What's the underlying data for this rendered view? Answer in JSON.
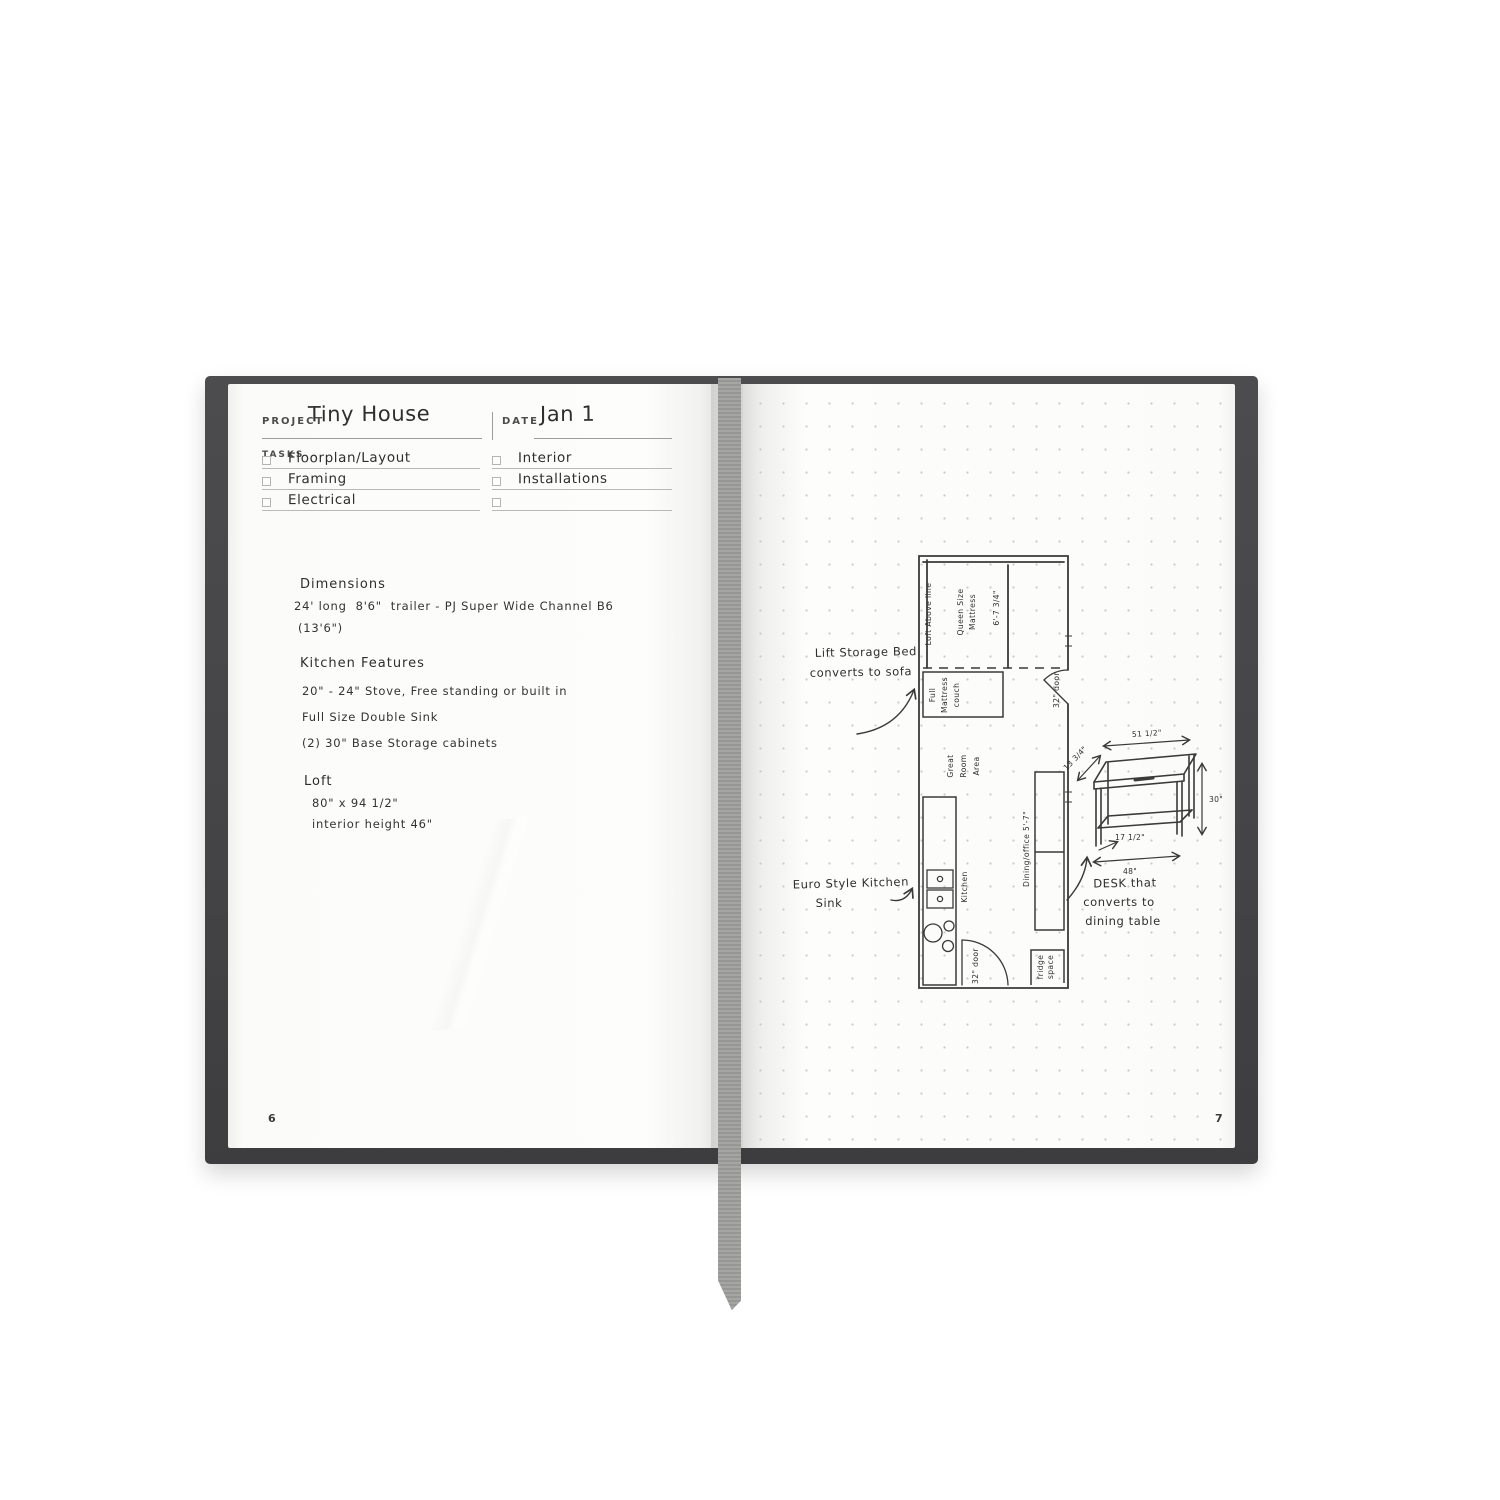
{
  "book": {
    "left_page_number": "6",
    "right_page_number": "7",
    "cover_color": "#454547",
    "ribbon_color": "#9a9a98",
    "ink_color": "#2e2e2e"
  },
  "left_page": {
    "project_label": "PROJECT",
    "project_value": "Tiny House",
    "date_label": "DATE",
    "date_value": "Jan 1",
    "tasks_label": "TASKS",
    "tasks_left": [
      "Floorplan/Layout",
      "Framing",
      "Electrical"
    ],
    "tasks_right": [
      "Interior",
      "Installations",
      ""
    ],
    "notes": {
      "dimensions_title": "Dimensions",
      "dimensions_line1": "24' long  8'6\"  trailer - PJ Super Wide Channel B6",
      "dimensions_line2": "(13'6\")",
      "kitchen_title": "Kitchen Features",
      "kitchen_line1": "20\" - 24\" Stove, Free standing or built in",
      "kitchen_line2": "Full Size Double Sink",
      "kitchen_line3": "(2) 30\" Base Storage cabinets",
      "loft_title": "Loft",
      "loft_line1": "80\" x 94 1/2\"",
      "loft_line2": "interior height 46\""
    }
  },
  "right_page": {
    "plan": {
      "loft_above_line": "Loft Above line",
      "queen_size": "Queen Size",
      "mattress": "Mattress",
      "dim_bed": "6'-7 3/4\"",
      "full": "Full",
      "mattress2": "Mattress",
      "couch": "couch",
      "door_top": "32\" door",
      "great": "Great",
      "room": "Room",
      "area": "Area",
      "kitchen": "Kitchen",
      "dining_office": "Dining/office  5'-7\"",
      "door_bottom": "32\" door",
      "fridge": "fridge",
      "space": "space"
    },
    "desk": {
      "dim_top": "51 1/2\"",
      "dim_depth": "13 3/4\"",
      "dim_height": "30\"",
      "dim_leg": "17 1/2\"",
      "dim_bottom": "48\""
    },
    "annotations": {
      "lift_bed_1": "Lift Storage Bed",
      "lift_bed_2": "converts to sofa",
      "euro_sink_1": "Euro Style Kitchen",
      "euro_sink_2": "Sink",
      "desk_note_1": "DESK that",
      "desk_note_2": "converts to",
      "desk_note_3": "dining table"
    }
  }
}
